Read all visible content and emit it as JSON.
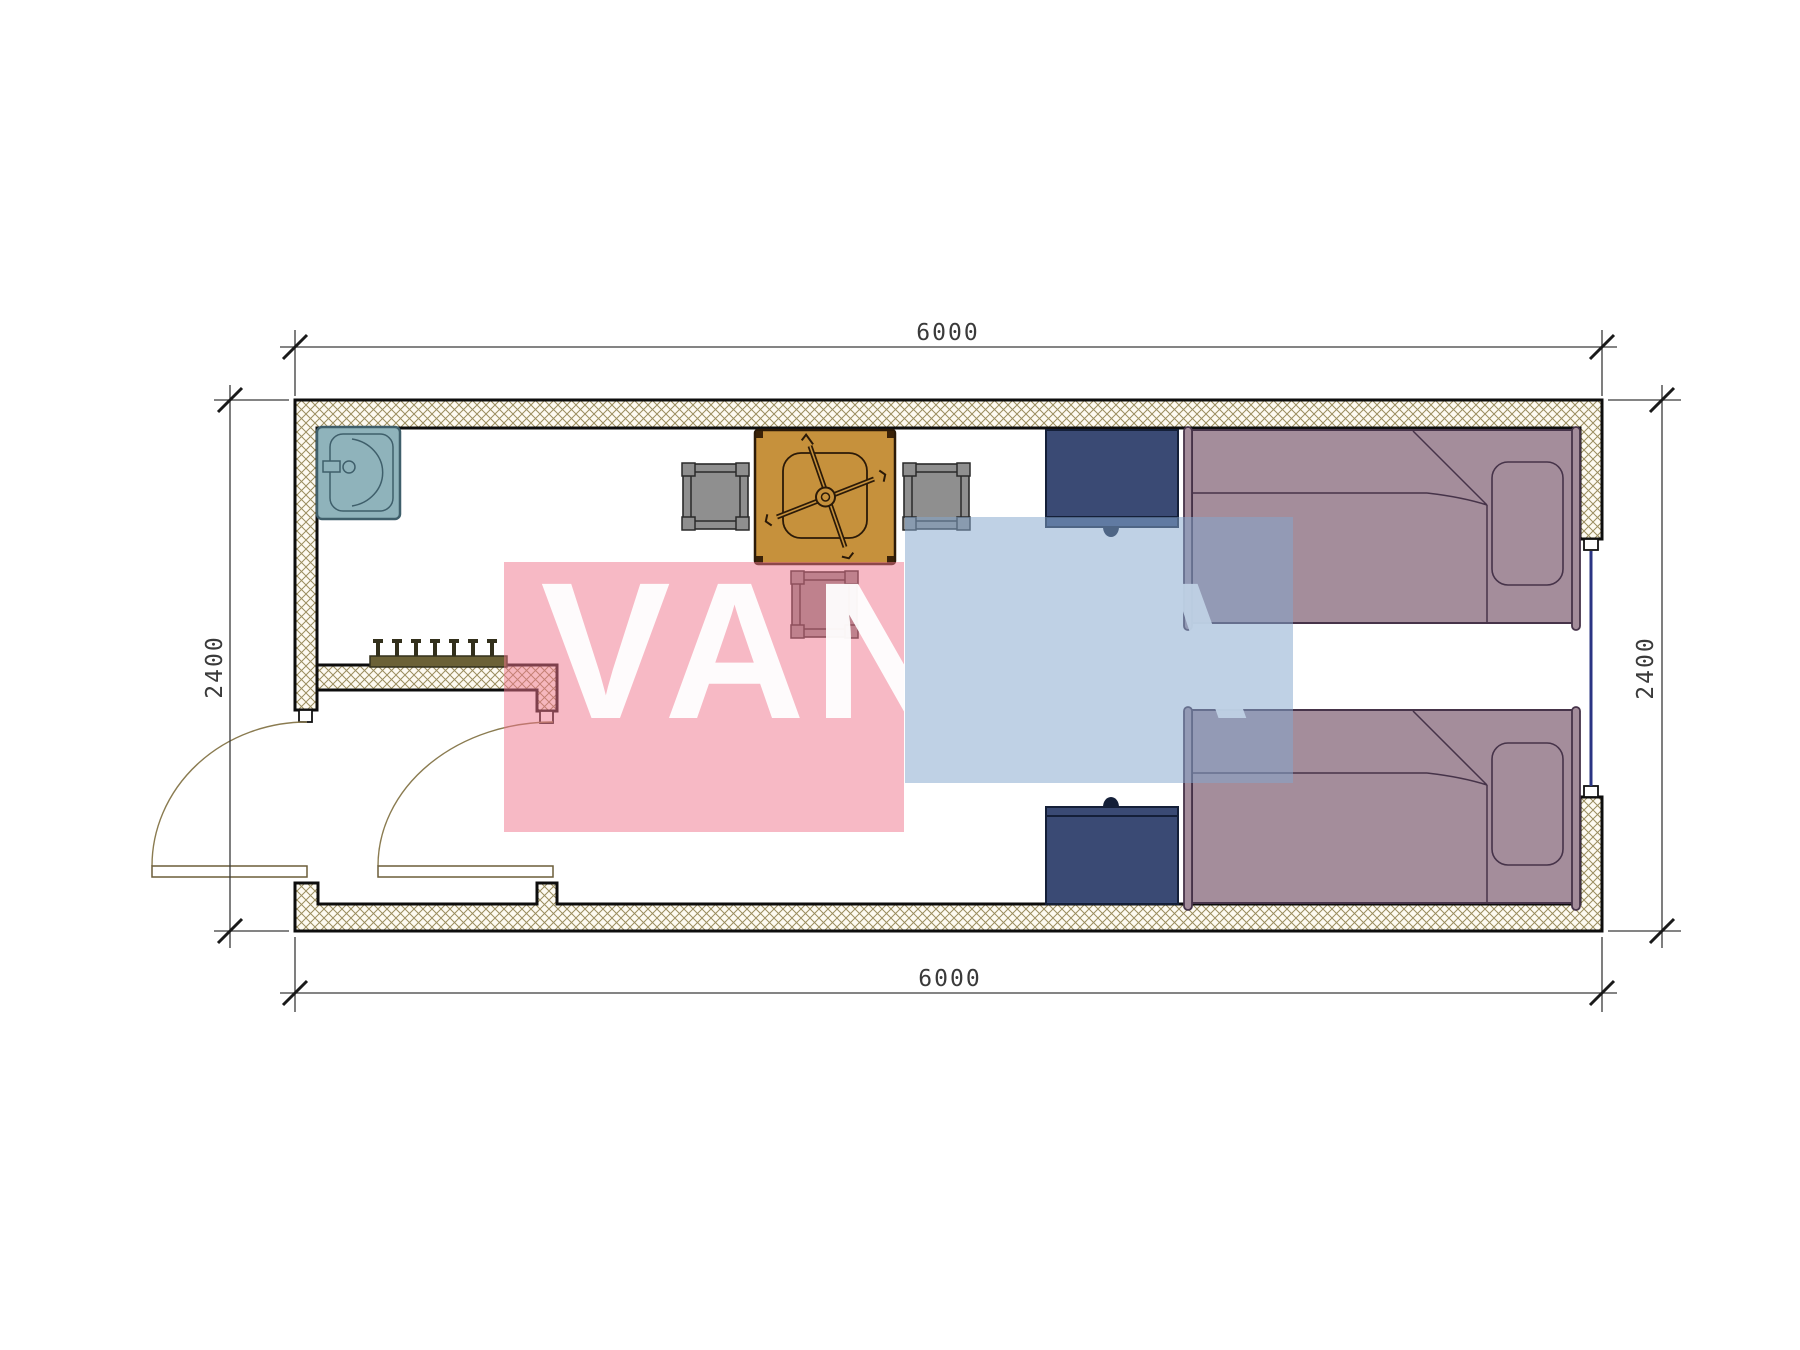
{
  "drawing": {
    "type": "floor-plan",
    "dimensions": {
      "top": "6000",
      "bottom": "6000",
      "left": "2400",
      "right": "2400"
    },
    "watermark": {
      "text": "VANDA",
      "text_color": "#ffffff",
      "pink_fill": "rgba(239,115,140,0.50)",
      "blue_fill": "rgba(133,167,205,0.52)"
    },
    "colors": {
      "wall_hatch_line": "#9a8d5e",
      "wall_fill": "#fdfaf1",
      "wall_outline": "#0d0d0d",
      "sink": "#8fb3bb",
      "sink_stroke": "#3f5f6b",
      "table": "#c6913c",
      "table_stroke": "#2b1a08",
      "chair": "#8f8f8f",
      "chair_stroke": "#2a2a2a",
      "bed": "#a48d9b",
      "bed_stroke": "#463349",
      "cabinet": "#3a4a74",
      "cabinet_stroke": "#141f38",
      "window_glass": "#2a3483",
      "door_arc": "#8a7b50",
      "coat_rack": "#6b6136",
      "dimension": "#3a3a3a"
    },
    "inventory": {
      "rooms": [
        "bathroom",
        "entry-vestibule",
        "bedroom"
      ],
      "furniture": [
        "sink",
        "coat-rack",
        "table",
        "chair",
        "chair",
        "chair",
        "cabinet",
        "cabinet",
        "single-bed",
        "single-bed"
      ],
      "doors": 2,
      "windows": 1
    }
  }
}
